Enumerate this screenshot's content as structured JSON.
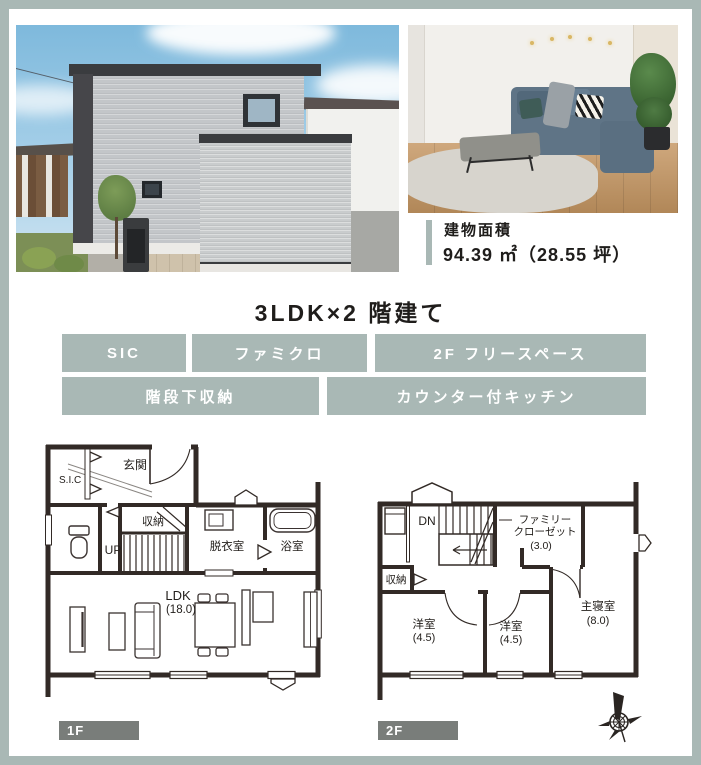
{
  "building_area": {
    "label": "建物面積",
    "value": "94.39 ㎡（28.55 坪）"
  },
  "title": "3LDK×2 階建て",
  "features": [
    "SIC",
    "ファミクロ",
    "2F フリースペース",
    "階段下収納",
    "カウンター付キッチン"
  ],
  "floorplans": {
    "f1": {
      "tag": "1F",
      "labels": {
        "genkan": "玄関",
        "sic": "S.I.C",
        "shuno": "収納",
        "up": "UP",
        "datsui": "脱衣室",
        "bath": "浴室",
        "ldk": "LDK",
        "ldk_size": "(18.0)"
      }
    },
    "f2": {
      "tag": "2F",
      "labels": {
        "dn": "DN",
        "fc1": "ファミリー",
        "fc2": "クローゼット",
        "fc_size": "(3.0)",
        "shuno": "収納",
        "yo1": "洋室",
        "yo1_size": "(4.5)",
        "yo2": "洋室",
        "yo2_size": "(4.5)",
        "master": "主寝室",
        "master_size": "(8.0)"
      }
    }
  },
  "colors": {
    "accent_sage": "#a9b8b5",
    "floor_badge_gray": "#797d7a",
    "plan_wall": "#322a26",
    "text": "#1f1d1b"
  }
}
